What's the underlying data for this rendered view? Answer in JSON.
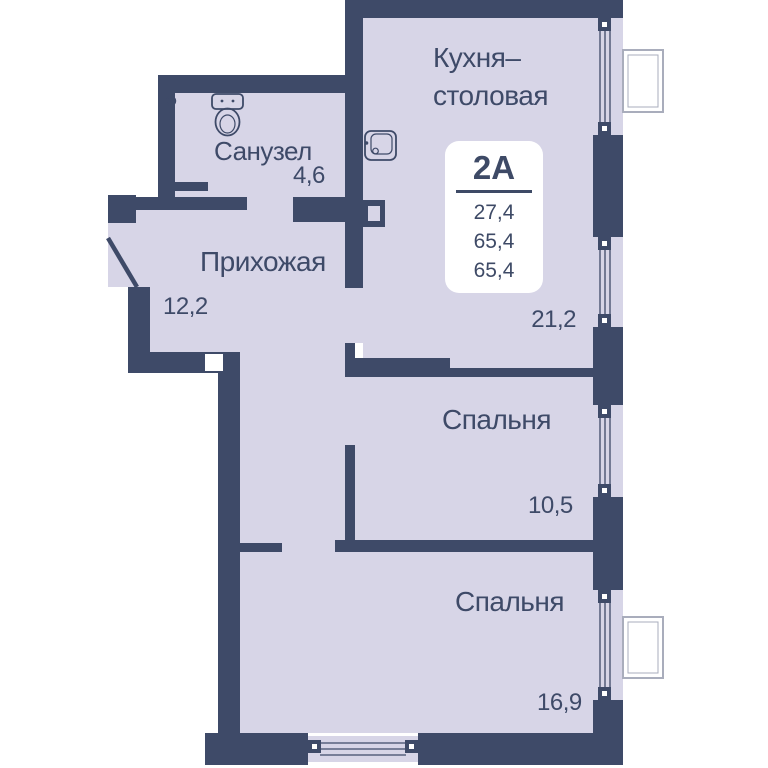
{
  "plan": {
    "title": "apartment floor plan 2A",
    "unit_card": {
      "unit_label": "2А",
      "areas": [
        "27,4",
        "65,4",
        "65,4"
      ]
    },
    "rooms": [
      {
        "id": "kitchen-dining",
        "name_line1": "Кухня–",
        "name_line2": "столовая",
        "area": "21,2"
      },
      {
        "id": "bathroom",
        "name": "Санузел",
        "area": "4,6"
      },
      {
        "id": "hallway",
        "name": "Прихожая",
        "area": "12,2"
      },
      {
        "id": "bedroom-1",
        "name": "Спальня",
        "area": "10,5"
      },
      {
        "id": "bedroom-2",
        "name": "Спальня",
        "area": "16,9"
      }
    ],
    "icons": {
      "toilet": "toilet-top-view",
      "sink": "kitchen-sink",
      "radiator": "towel-radiator",
      "door": "entrance-door-swing",
      "windows": "triple-glazed-window-strips",
      "balconies": "balcony-outline"
    },
    "colors": {
      "wall": "#3e4a68",
      "floor": "#d7d5e7",
      "background": "#ffffff",
      "text": "#3e4a66",
      "card_background": "#ffffff",
      "balcony_outline": "#a9adbc"
    }
  }
}
